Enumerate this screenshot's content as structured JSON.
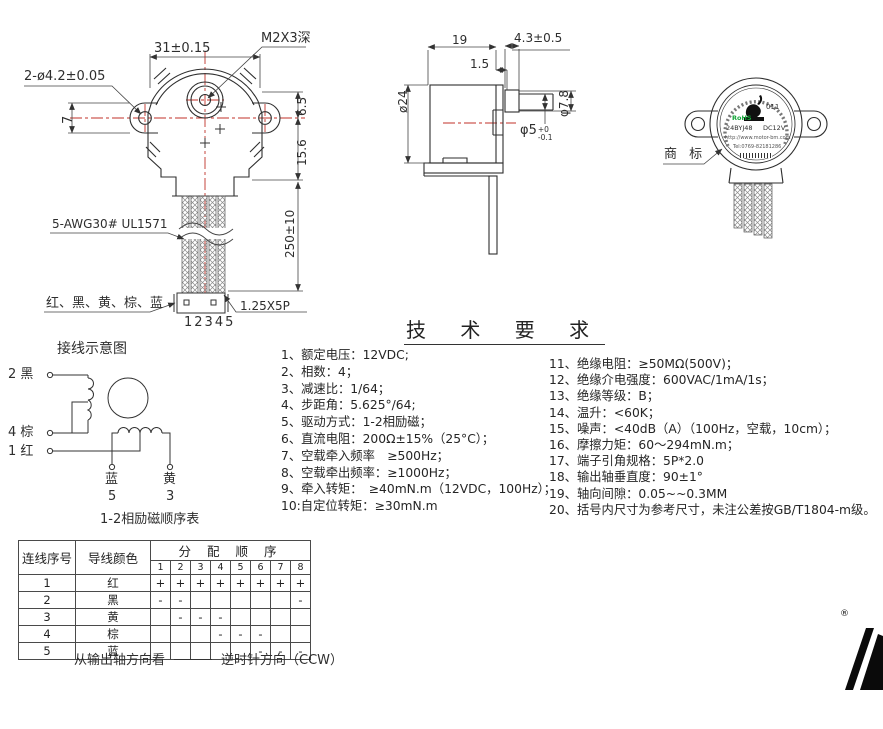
{
  "front_view": {
    "mount_holes": "2-ø4.2±0.05",
    "hole_spacing": "31±0.15",
    "screw_depth": "M2X3深",
    "ear_offset": "7",
    "dim_6_5": "6.5",
    "dim_15_6": "15.6",
    "wire_length": "250±10",
    "wire_spec": "5-AWG30# UL1571",
    "wire_colors": "红、黑、黄、棕、蓝",
    "pin_numbers": "12345",
    "connector_spec": "1.25X5P"
  },
  "side_view": {
    "body_len": "19",
    "shaft_len": "4.3±0.5",
    "step": "1.5",
    "body_dia": "ø24",
    "shaft_dia": "φ5",
    "shaft_tol_plus": "+0",
    "shaft_tol_minus": "-0.1",
    "collar_dia": "φ7.8"
  },
  "rear_view": {
    "callout": "商 标",
    "logo_text": "011",
    "rohs": "RoHS",
    "model": "24BYJ48",
    "voltage": "DC12V",
    "url": "http://www.motor-bm.com",
    "tel": "Tel:0769-82181286"
  },
  "tech": {
    "title": "技 术 要 求",
    "left": [
      "1、额定电压：12VDC;",
      "2、相数：4；",
      "3、减速比：1/64；",
      "4、步距角：5.625°/64;",
      "5、驱动方式：1-2相励磁；",
      "6、直流电阻：200Ω±15%（25°C）；",
      "7、空载牵入频率　≥500Hz；",
      "8、空载牵出频率：≥1000Hz；",
      "9、牵入转矩：　≥40mN.m（12VDC，100Hz）；",
      "10:自定位转矩：≥30mN.m"
    ],
    "right": [
      "11、绝缘电阻：≥50MΩ(500V)；",
      "12、绝缘介电强度：600VAC/1mA/1s；",
      "13、绝缘等级：B；",
      "14、温升：<60K；",
      "15、噪声：<40dB（A）（100Hz，空载，10cm）；",
      "16、摩擦力矩：60～294mN.m；",
      "17、端子引角规格：5P*2.0",
      "18、输出轴垂直度：90±1°",
      "19、轴向间隙：0.05~~0.3MM",
      "20、括号内尺寸为参考尺寸，未注公差按GB/T1804-m级。"
    ]
  },
  "wiring": {
    "title": "接线示意图",
    "t2": "2 黑",
    "t4": "4 棕",
    "t1": "1 红",
    "blue": "蓝",
    "yellow": "黄",
    "pin5": "5",
    "pin3": "3",
    "caption": "1-2相励磁顺序表"
  },
  "seq_table": {
    "col1": "连线序号",
    "col2": "导线颜色",
    "span_header": "分 配 顺 序",
    "steps": [
      "1",
      "2",
      "3",
      "4",
      "5",
      "6",
      "7",
      "8"
    ],
    "rows": [
      {
        "no": "1",
        "color": "红",
        "cells": [
          "+",
          "+",
          "+",
          "+",
          "+",
          "+",
          "+",
          "+"
        ]
      },
      {
        "no": "2",
        "color": "黑",
        "cells": [
          "-",
          "-",
          "",
          "",
          "",
          "",
          "",
          "-"
        ]
      },
      {
        "no": "3",
        "color": "黄",
        "cells": [
          "",
          "-",
          "-",
          "-",
          "",
          "",
          "",
          ""
        ]
      },
      {
        "no": "4",
        "color": "棕",
        "cells": [
          "",
          "",
          "",
          "-",
          "-",
          "-",
          "",
          ""
        ]
      },
      {
        "no": "5",
        "color": "蓝",
        "cells": [
          "",
          "",
          "",
          "",
          "",
          "-",
          "-",
          "-"
        ]
      }
    ],
    "footer_pre": "从输出轴方向看",
    "footer_post": "逆时针方向（CCW）"
  },
  "brand": {
    "registered": "®"
  },
  "colors": {
    "centerline": "#c03228",
    "line": "#333333",
    "rohs_green": "#13a538"
  }
}
